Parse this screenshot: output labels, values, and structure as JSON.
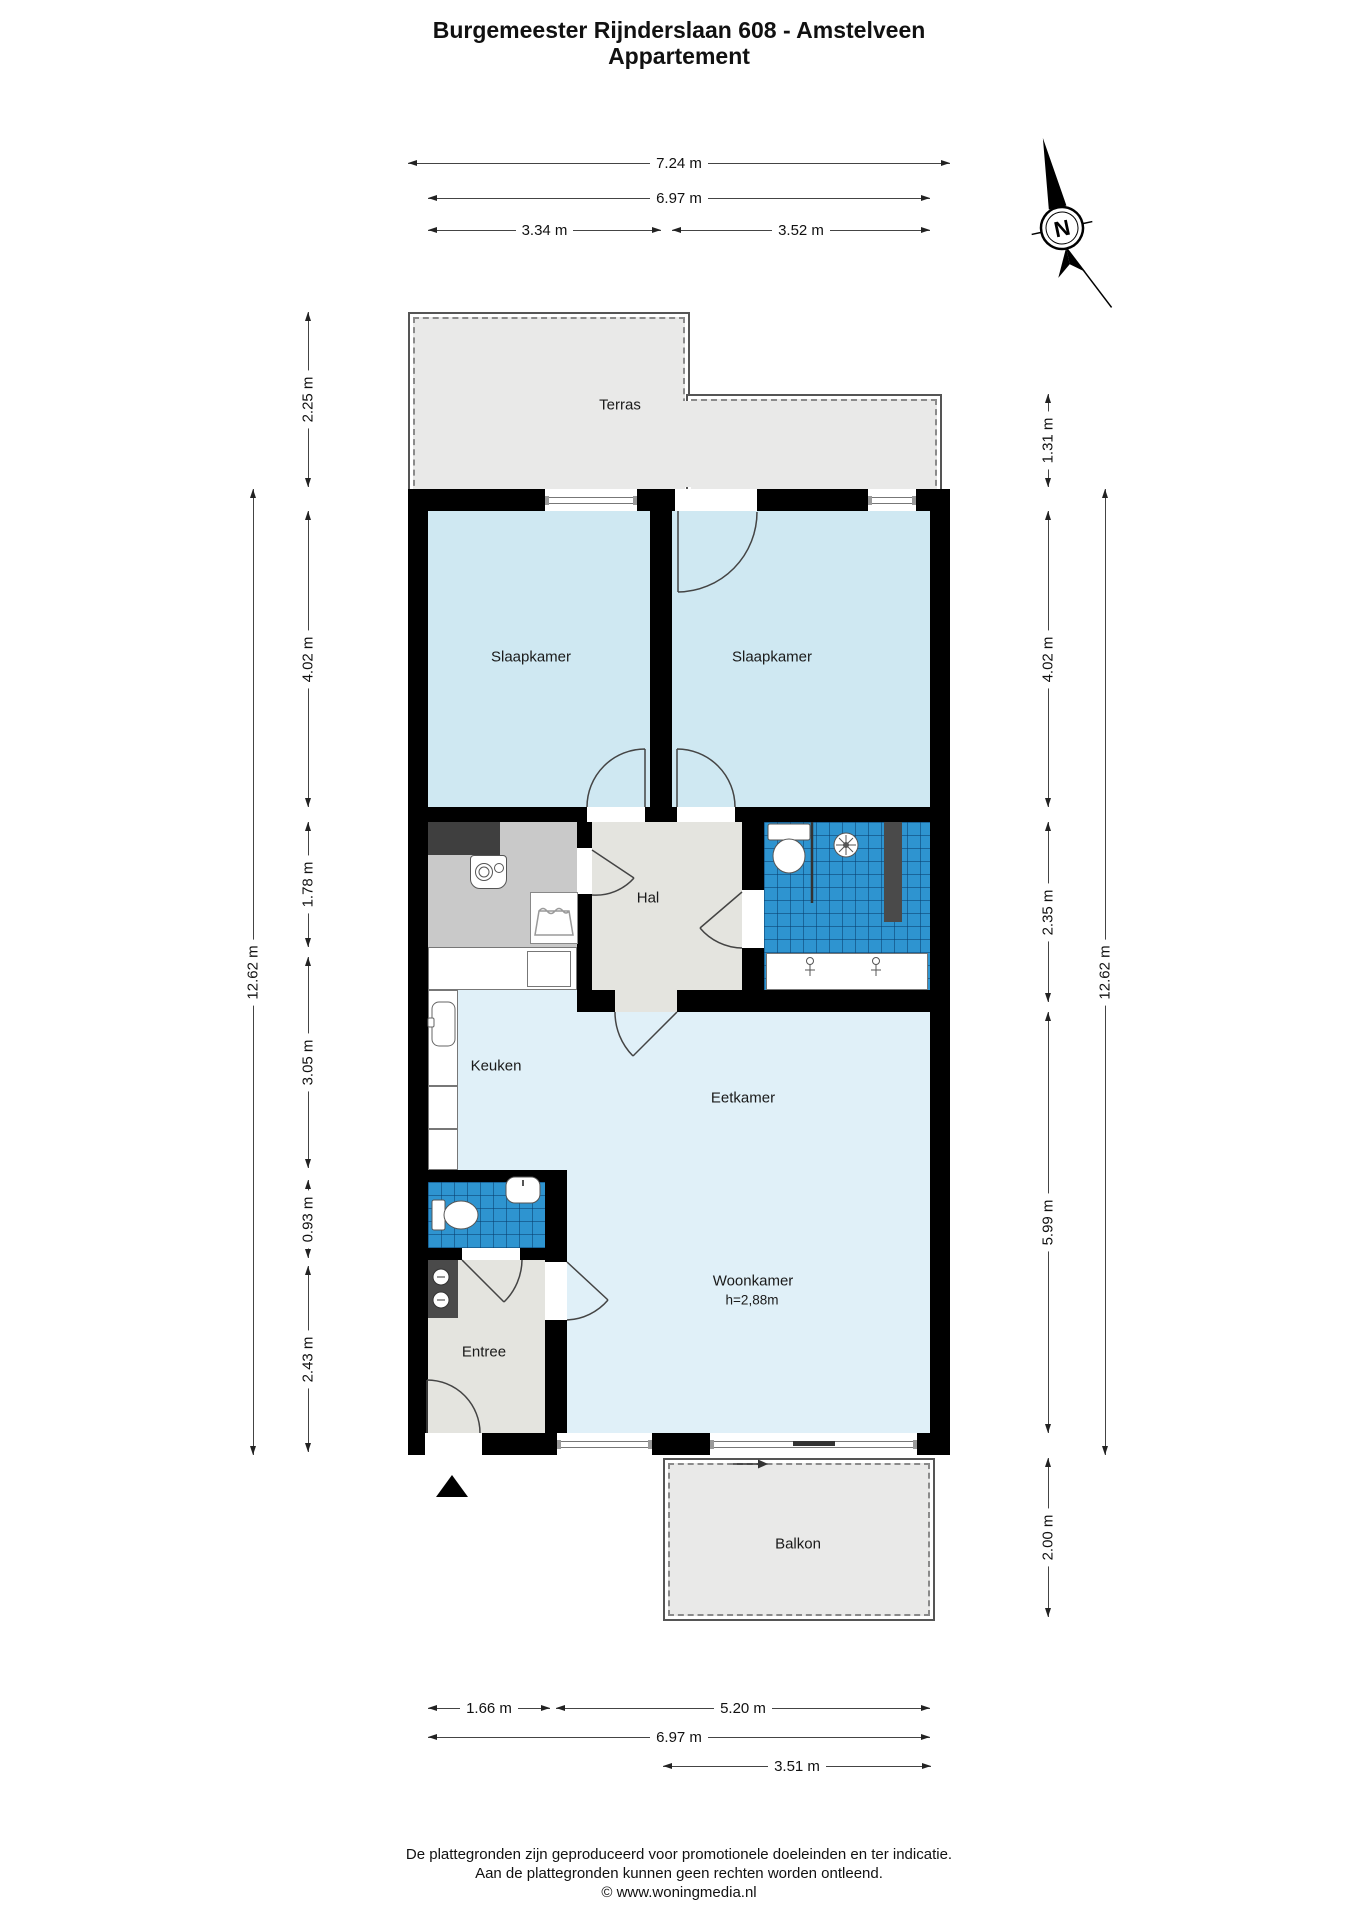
{
  "title": {
    "line1": "Burgemeester Rijnderslaan 608 - Amstelveen",
    "line2": "Appartement"
  },
  "compass": {
    "label": "N"
  },
  "rooms": {
    "terras": "Terras",
    "slaapkamer_left": "Slaapkamer",
    "slaapkamer_right": "Slaapkamer",
    "hal": "Hal",
    "keuken": "Keuken",
    "eetkamer": "Eetkamer",
    "woonkamer": "Woonkamer",
    "woonkamer_height": "h=2,88m",
    "entree": "Entree",
    "balkon": "Balkon"
  },
  "dims": {
    "top_total": "7.24 m",
    "top_inner": "6.97 m",
    "top_left_room": "3.34 m",
    "top_right_room": "3.52 m",
    "left_total": "12.62 m",
    "left_terras": "2.25 m",
    "left_slaapkamer": "4.02 m",
    "left_berging": "1.78 m",
    "left_keuken": "3.05 m",
    "left_toilet": "0.93 m",
    "left_entree": "2.43 m",
    "right_terras": "1.31 m",
    "right_slaapkamer": "4.02 m",
    "right_badkamer": "2.35 m",
    "right_woonkamer": "5.99 m",
    "right_balkon": "2.00 m",
    "right_total": "12.62 m",
    "bottom_entree": "1.66 m",
    "bottom_woonkamer": "5.20 m",
    "bottom_inner": "6.97 m",
    "bottom_balkon": "3.51 m"
  },
  "footer": {
    "line1": "De plattegronden zijn geproduceerd voor promotionele doeleinden en ter indicatie.",
    "line2": "Aan de plattegronden kunnen geen rechten worden ontleend.",
    "line3": "© www.woningmedia.nl"
  },
  "colors": {
    "wall": "#000000",
    "bedroom_fill": "#cfe8f2",
    "living_fill": "#e0f0f8",
    "tile_fill": "#2e94d0",
    "hall_fill": "#e4e4df",
    "utility_fill": "#c9c9c9",
    "outdoor_fill": "#e9e9e8"
  }
}
